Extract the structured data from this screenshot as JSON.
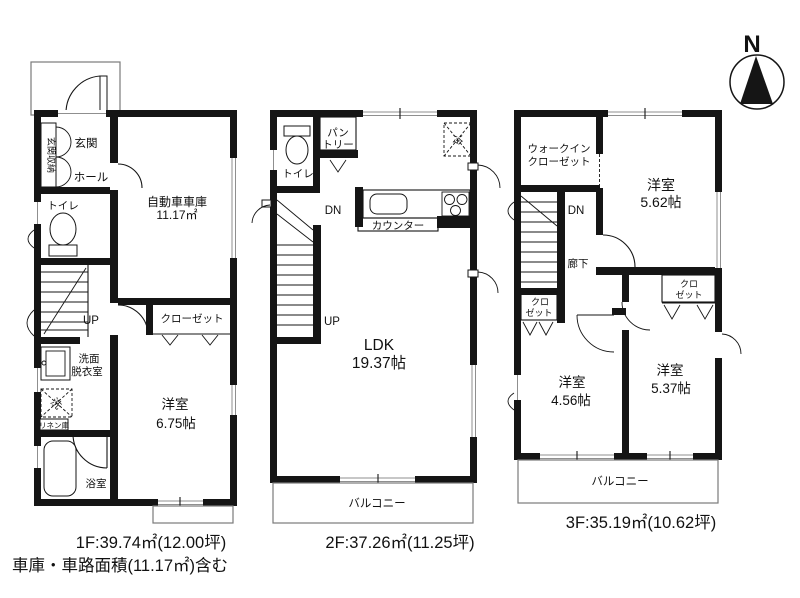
{
  "compass": {
    "north_label": "N"
  },
  "colors": {
    "wall": "#151515",
    "window_line": "#8f8f8f",
    "background": "#ffffff"
  },
  "floors": {
    "f1": {
      "caption": "1F:39.74㎡(12.00坪)",
      "note": "車庫・車路面積(11.17㎡)含む",
      "labels": {
        "entrance_storage": "玄関収納",
        "entrance": "玄関",
        "hall": "ホール",
        "toilet": "トイレ",
        "garage_name": "自動車車庫",
        "garage_area": "11.17㎡",
        "stairs_up": "UP",
        "closet": "クローゼット",
        "washroom_1": "洗面",
        "washroom_2": "脱衣室",
        "washer": "洗",
        "linen": "リネン庫",
        "bathroom": "浴室",
        "bedroom_name": "洋室",
        "bedroom_size": "6.75帖"
      }
    },
    "f2": {
      "caption": "2F:37.26㎡(11.25坪)",
      "labels": {
        "toilet": "トイレ",
        "pantry_1": "パン",
        "pantry_2": "トリー",
        "fridge": "冷",
        "stairs_dn": "DN",
        "stairs_up": "UP",
        "counter": "カウンター",
        "ldk_name": "LDK",
        "ldk_size": "19.37帖",
        "balcony": "バルコニー"
      }
    },
    "f3": {
      "caption": "3F:35.19㎡(10.62坪)",
      "labels": {
        "wic_1": "ウォークイン",
        "wic_2": "クローゼット",
        "stairs_dn": "DN",
        "corridor": "廊下",
        "closet_a_1": "クロ",
        "closet_a_2": "ゼット",
        "closet_b_1": "クロ",
        "closet_b_2": "ゼット",
        "bedroom1_name": "洋室",
        "bedroom1_size": "5.62帖",
        "bedroom2_name": "洋室",
        "bedroom2_size": "4.56帖",
        "bedroom3_name": "洋室",
        "bedroom3_size": "5.37帖",
        "balcony": "バルコニー"
      }
    }
  }
}
